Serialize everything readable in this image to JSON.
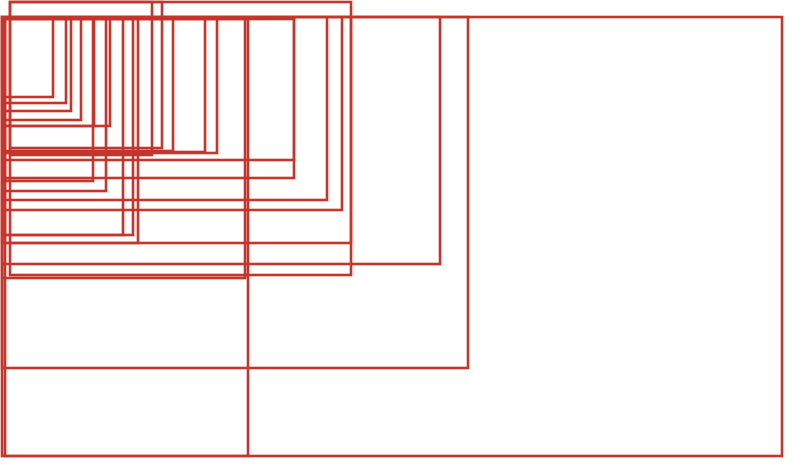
{
  "canvas": {
    "width": 800,
    "height": 475,
    "background_color": "#ffffff",
    "stroke_color": "#c5352b",
    "stroke_width": 2.6,
    "title": ""
  },
  "chart_data": {
    "type": "table",
    "title": "",
    "description": "Nested overlapping red outlined rectangles size-comparison diagram; all rectangles share a top-left anchor region and fan out to staggered bottom-right corners",
    "rectangles": [
      {
        "name": "rect-01",
        "x": 5,
        "y": 19,
        "w": 48,
        "h": 78
      },
      {
        "name": "rect-02",
        "x": 2,
        "y": 17,
        "w": 64,
        "h": 86
      },
      {
        "name": "rect-03",
        "x": 5,
        "y": 19,
        "w": 66,
        "h": 92
      },
      {
        "name": "rect-04",
        "x": 2,
        "y": 17,
        "w": 79,
        "h": 103
      },
      {
        "name": "rect-05",
        "x": 5,
        "y": 19,
        "w": 89,
        "h": 107
      },
      {
        "name": "rect-06",
        "x": 2,
        "y": 17,
        "w": 108,
        "h": 109
      },
      {
        "name": "rect-07",
        "x": 2,
        "y": 17,
        "w": 91,
        "h": 164
      },
      {
        "name": "rect-08",
        "x": 2,
        "y": 17,
        "w": 104,
        "h": 174
      },
      {
        "name": "rect-09",
        "x": 2,
        "y": 17,
        "w": 121,
        "h": 218
      },
      {
        "name": "rect-10",
        "x": 5,
        "y": 19,
        "w": 128,
        "h": 216
      },
      {
        "name": "rect-11",
        "x": 5,
        "y": 19,
        "w": 133,
        "h": 224
      },
      {
        "name": "rect-12",
        "x": 10,
        "y": 2,
        "w": 142,
        "h": 153
      },
      {
        "name": "rect-13",
        "x": 10,
        "y": 2,
        "w": 152,
        "h": 146
      },
      {
        "name": "rect-14",
        "x": 2,
        "y": 17,
        "w": 171,
        "h": 134
      },
      {
        "name": "rect-15",
        "x": 2,
        "y": 17,
        "w": 203,
        "h": 135
      },
      {
        "name": "rect-16",
        "x": 5,
        "y": 19,
        "w": 212,
        "h": 134
      },
      {
        "name": "rect-17",
        "x": 2,
        "y": 17,
        "w": 292,
        "h": 143
      },
      {
        "name": "rect-18",
        "x": 5,
        "y": 19,
        "w": 289,
        "h": 159
      },
      {
        "name": "rect-19",
        "x": 2,
        "y": 17,
        "w": 325,
        "h": 183
      },
      {
        "name": "rect-20",
        "x": 2,
        "y": 17,
        "w": 340,
        "h": 193
      },
      {
        "name": "rect-21",
        "x": 2,
        "y": 17,
        "w": 349,
        "h": 226
      },
      {
        "name": "rect-22",
        "x": 10,
        "y": 2,
        "w": 341,
        "h": 273
      },
      {
        "name": "rect-23",
        "x": 2,
        "y": 17,
        "w": 243,
        "h": 261
      },
      {
        "name": "rect-24",
        "x": 5,
        "y": 19,
        "w": 243,
        "h": 437
      },
      {
        "name": "rect-25",
        "x": 2,
        "y": 17,
        "w": 438,
        "h": 247
      },
      {
        "name": "rect-26",
        "x": 2,
        "y": 17,
        "w": 466,
        "h": 351
      },
      {
        "name": "rect-27",
        "x": 2,
        "y": 17,
        "w": 780,
        "h": 439
      }
    ]
  }
}
